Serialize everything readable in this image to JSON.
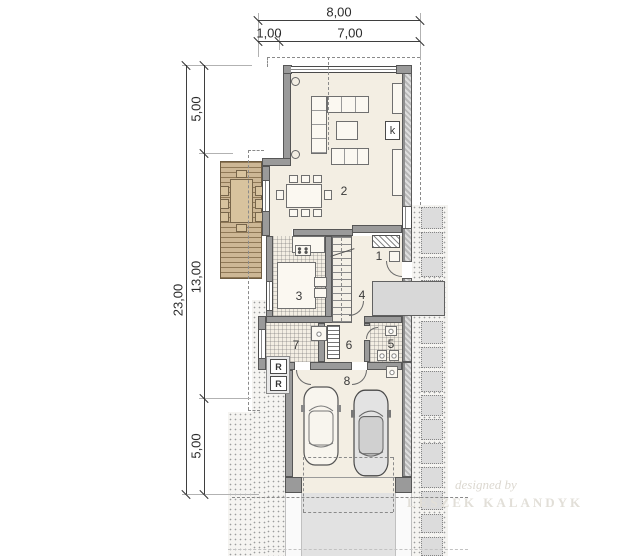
{
  "dimensions": {
    "top_total": "8,00",
    "top_seg1": "1,00",
    "top_seg2": "7,00",
    "left_total": "23,00",
    "left_seg1": "5,00",
    "left_seg2": "13,00",
    "left_seg3": "5,00"
  },
  "rooms": {
    "r1": "1",
    "r2": "2",
    "r3": "3",
    "r4": "4",
    "r5": "5",
    "r6": "6",
    "r7": "7",
    "r8": "8"
  },
  "markers": {
    "fireplace": "k",
    "radiator_a": "R",
    "radiator_b": "R"
  },
  "watermark": {
    "line1": "designed by",
    "line2": "LESZEK KALANDYK"
  },
  "colors": {
    "wall": "#9a9a9a",
    "floor": "#f3eee3",
    "deck": "#cdb795",
    "porch": "#d8d8d8",
    "driveway": "#e2e2e2",
    "dash": "#8a8a8a",
    "dim_text": "#2b2b2b"
  }
}
